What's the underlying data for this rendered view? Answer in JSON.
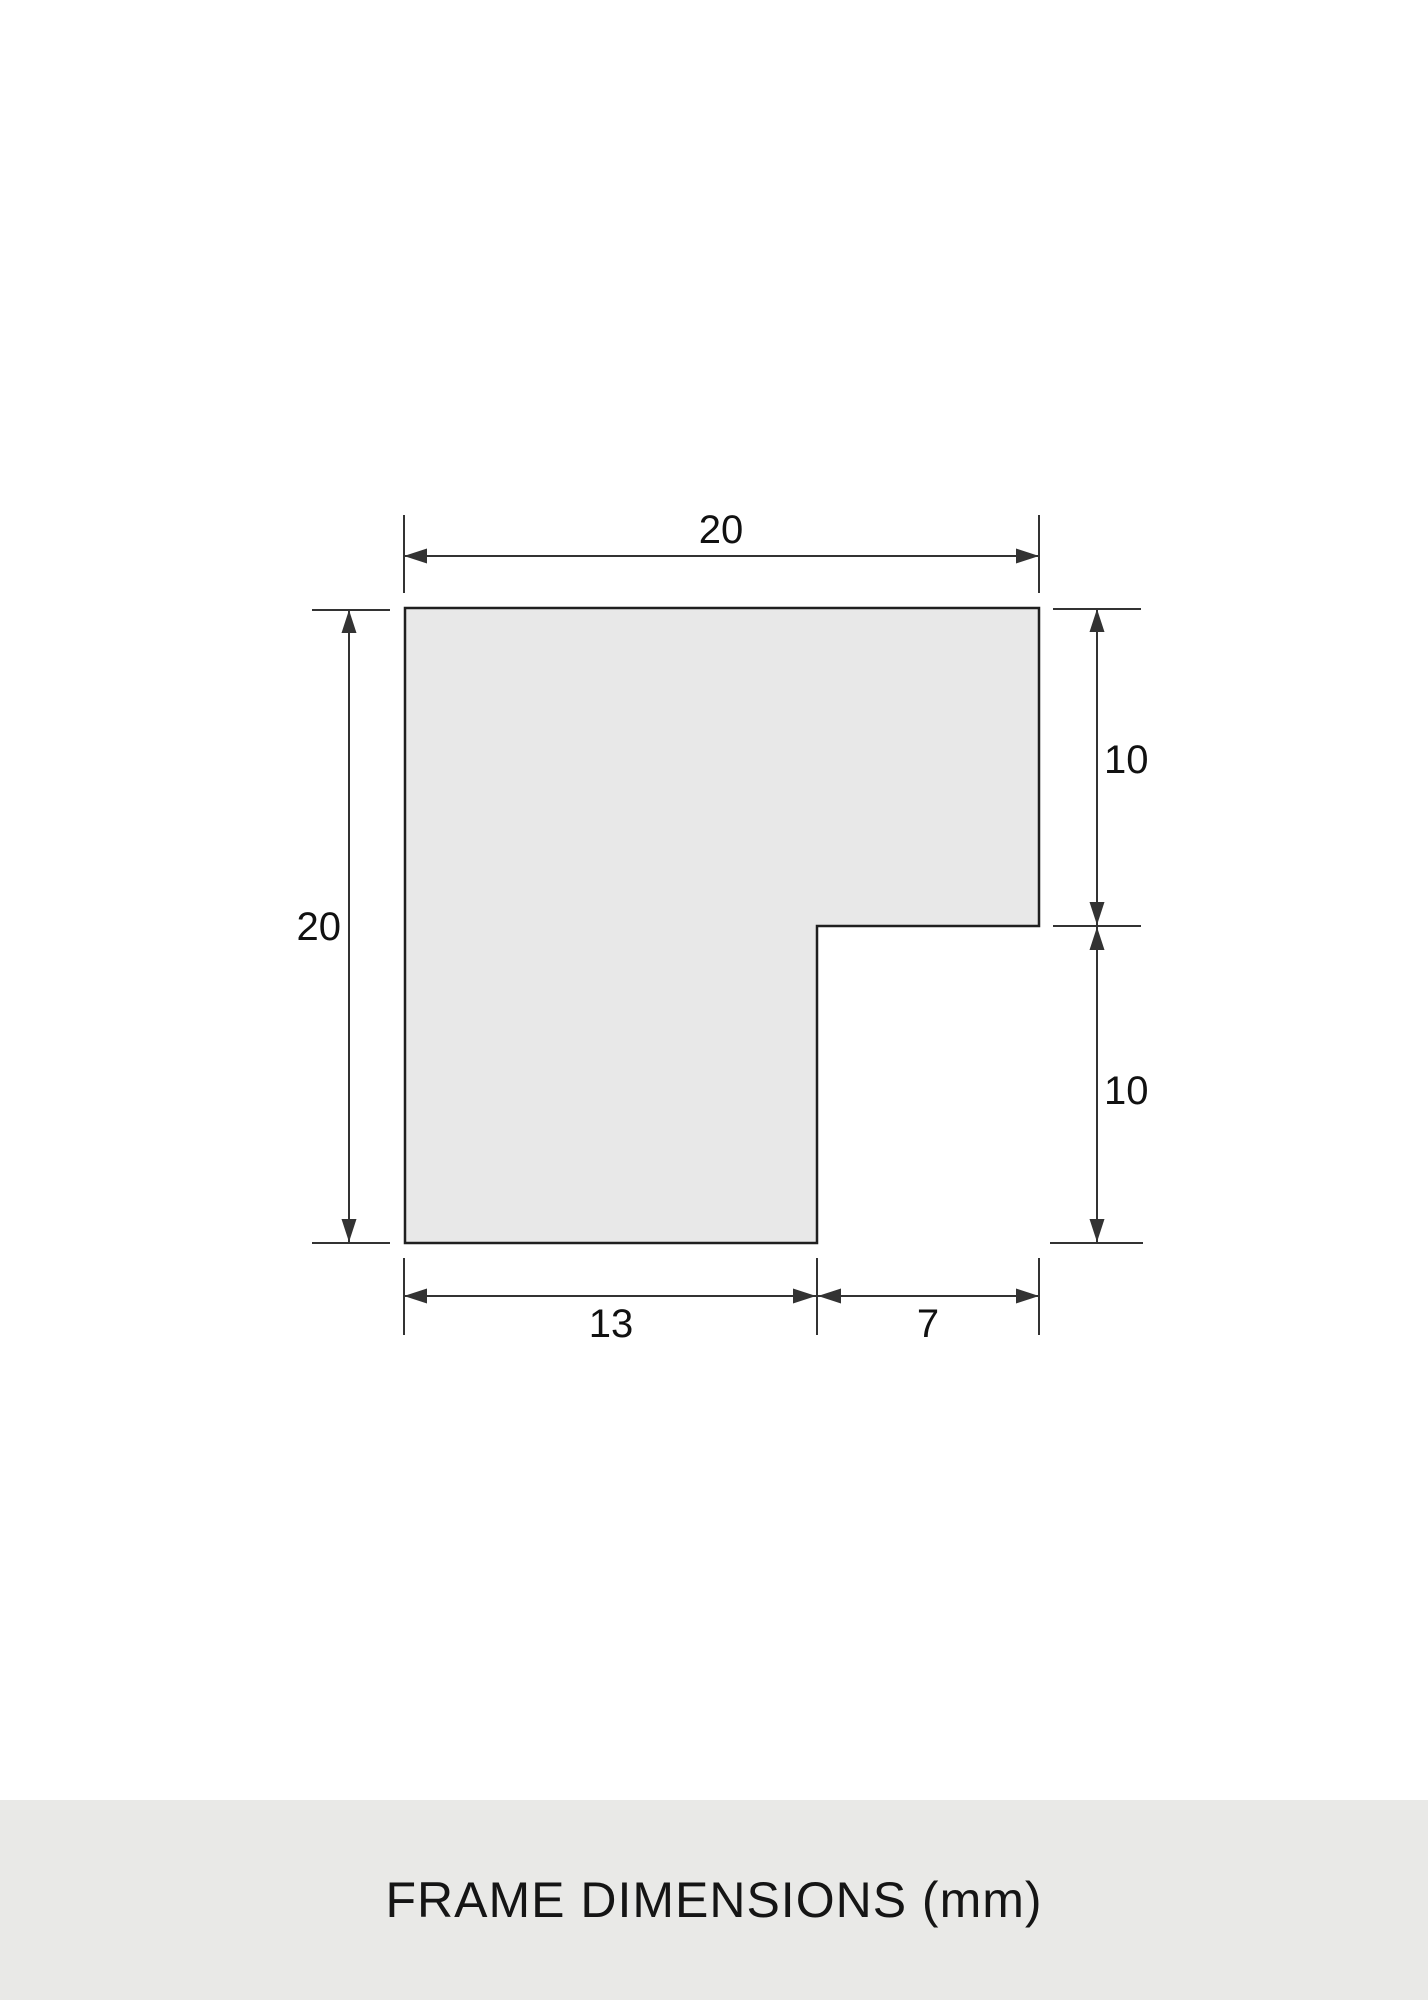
{
  "caption": {
    "text": "FRAME DIMENSIONS (mm)"
  },
  "diagram": {
    "type": "technical-drawing",
    "subject": "frame-moulding-cross-section",
    "unit": "mm",
    "dimensions": {
      "top_width": {
        "label": "20",
        "value": 20
      },
      "left_height": {
        "label": "20",
        "value": 20
      },
      "right_upper": {
        "label": "10",
        "value": 10
      },
      "right_lower": {
        "label": "10",
        "value": 10
      },
      "bottom_left": {
        "label": "13",
        "value": 13
      },
      "bottom_right": {
        "label": "7",
        "value": 7
      }
    },
    "colors": {
      "background": "#ffffff",
      "shape_fill": "#e8e8e8",
      "shape_outline": "#1f1f1f",
      "dimension_line": "#333333",
      "label_text": "#111111",
      "caption_band": "#e9e9e7"
    }
  }
}
